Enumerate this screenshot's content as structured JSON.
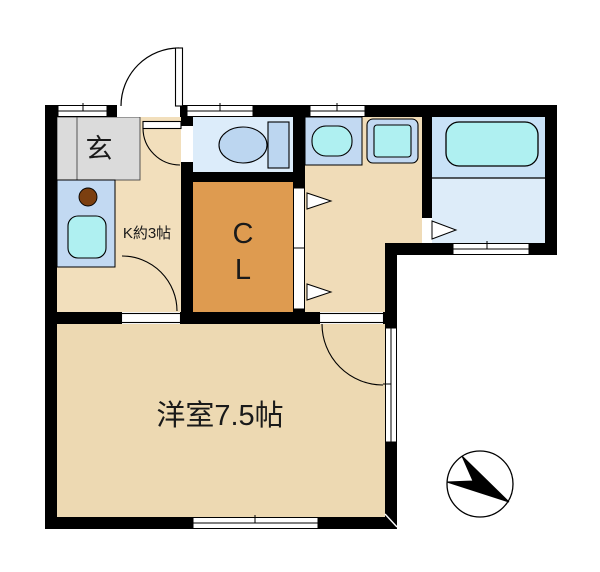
{
  "page": {
    "background": "#ffffff"
  },
  "colors": {
    "wall": "#000000",
    "hall_kitchen_floor": "#f2dfbc",
    "washroom_floor": "#f0dcb8",
    "main_room_floor": "#edd9b2",
    "genkan_gray": "#dbdbdb",
    "toilet_room_blue": "#dcecfa",
    "bath_zone_blue": "#c9e2f7",
    "bath_floor_blue": "#ddecf9",
    "closet_orange": "#de9b50",
    "fixture_panel_blue": "#c2d9f2",
    "fixture_water_cyan": "#aff0f1",
    "toilet_fixture_blue": "#bcd6f0",
    "burner_brown": "#7b3f10",
    "door_white": "#ffffff",
    "compass_black": "#000000"
  },
  "labels": {
    "genkan": "玄",
    "kitchen": "K約3帖",
    "closet_c": "C",
    "closet_l": "L",
    "main_room": "洋室7.5帖"
  }
}
